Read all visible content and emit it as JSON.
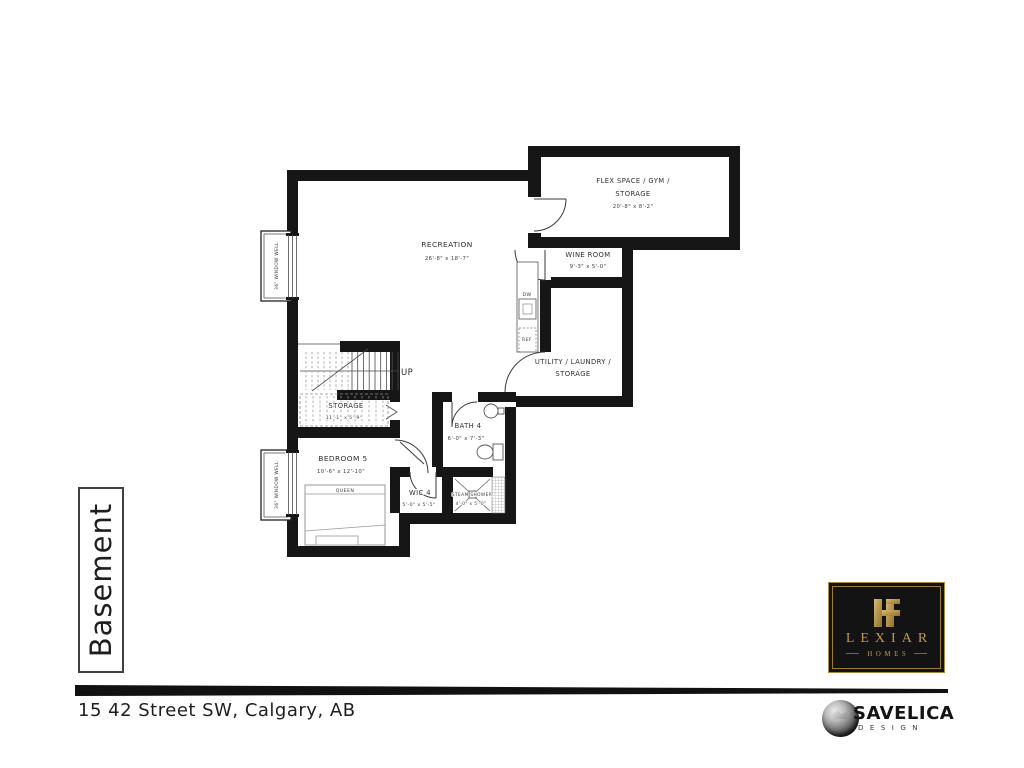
{
  "page": {
    "sheet_title": "Basement",
    "address": "15 42 Street SW, Calgary, AB"
  },
  "plan": {
    "rooms": {
      "recreation": {
        "name": "RECREATION",
        "dims": "26'-8\" x 18'-7\""
      },
      "flex": {
        "name_line1": "FLEX SPACE / GYM /",
        "name_line2": "STORAGE",
        "dims": "20'-8\" x 8'-2\""
      },
      "wine": {
        "name": "WINE ROOM",
        "dims": "9'-3\" x 5'-0\""
      },
      "utility": {
        "name_line1": "UTILITY / LAUNDRY /",
        "name_line2": "STORAGE"
      },
      "storage": {
        "name": "STORAGE",
        "dims": "11'-1\" x 5'-9\""
      },
      "bedroom": {
        "name": "BEDROOM 5",
        "dims": "10'-6\" x 12'-10\""
      },
      "bath": {
        "name": "BATH 4",
        "dims": "6'-0\" x 7'-3\""
      },
      "wic": {
        "name": "WIC 4",
        "dims": "5'-0\" x 5'-5\""
      },
      "steam_shower": {
        "name": "STEAM SHOWER",
        "dims": "4'-0\" x 5'-0\""
      }
    },
    "labels": {
      "up": "UP",
      "dishwasher": "DW",
      "fridge": "REF",
      "bed": "QUEEN",
      "window_well": "36\" WINDOW WELL"
    }
  },
  "branding": {
    "builder": {
      "name": "LEXIAR",
      "tagline": "HOMES"
    },
    "designer": {
      "name": "SAVELICA",
      "tagline": "DESIGN"
    }
  },
  "colors": {
    "gold": "#bb9a52",
    "ink": "#161616"
  }
}
